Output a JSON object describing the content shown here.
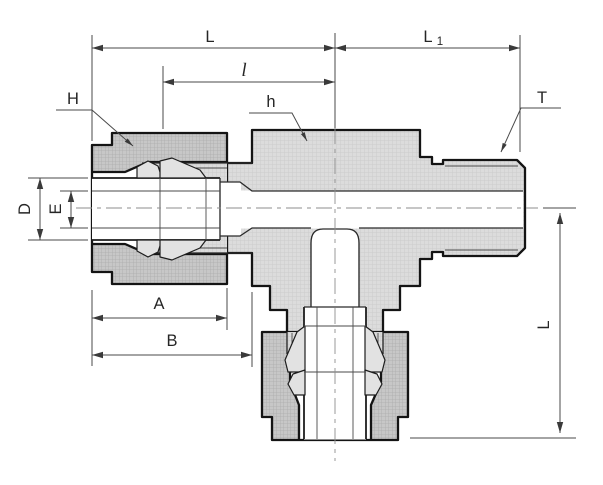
{
  "figure": {
    "type": "technical-drawing-cross-section",
    "labels": {
      "L": "L",
      "L1_base": "L",
      "L1_sub": "1",
      "l": "l",
      "H": "H",
      "h": "h",
      "T": "T",
      "D": "D",
      "E": "E",
      "A": "A",
      "B": "B",
      "L_vertical": "L"
    },
    "colors": {
      "background": "#ffffff",
      "body_fill": "#dcdcdc",
      "body_grid": "#c9c9c9",
      "nut_fill": "#c7c7c7",
      "nut_grid": "#adadad",
      "outline": "#141414",
      "dimension_line": "#4a4a4a",
      "label_text": "#262626",
      "centerline": "#8e8e8e"
    }
  }
}
